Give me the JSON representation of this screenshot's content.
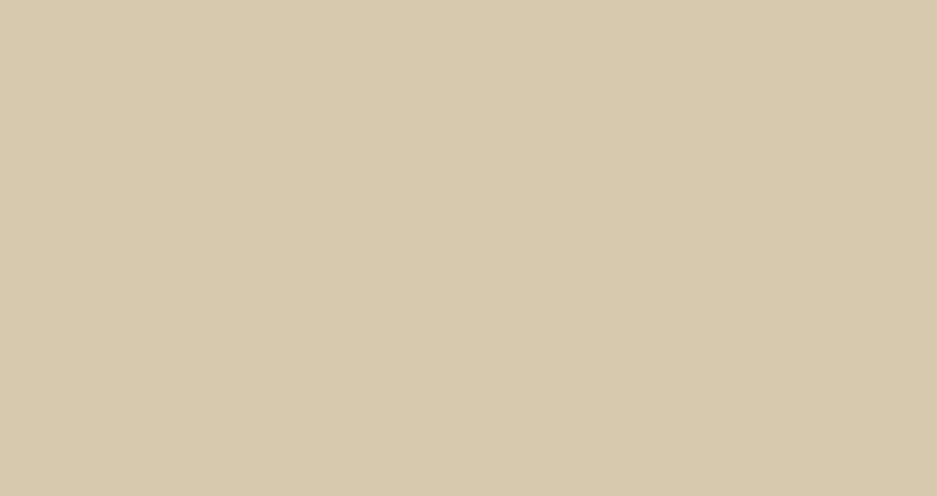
{
  "scene": {
    "type": "aerial-architectural-rendering",
    "description": "Bird's-eye architectural rendering of a large exhibition and trade-market campus: rows of steel blue-grey vaulted exhibition halls with white curved skylights, a diagonal spine of curved white-ribbed pod buildings with pale yellow-green oval roofs, two striped elliptical glass towers and a stacked white lattice tower, a central white lattice canopy over a road crossing, a wide tree-lined boulevard on the west, dense forest to the north-west, apartment blocks among trees on the east and south, a dark canal along the south-east edge with a road bridge, truck yards, parking rows and palm-lined internal streets, all washed by warm hazy sunlight from the upper left.",
    "setting": "daytime, warm sun flare from upper-left corner",
    "inventory": {
      "large_exhibition_halls": 11,
      "market_canopy_strips": 9,
      "organic_pod_buildings": 11,
      "striped_elliptical_towers": 2,
      "lattice_tower_tiers": 4,
      "central_lattice_canopy": 1,
      "pedestrian_bridges": 2,
      "sports_field": 1,
      "apartment_blocks": "~30",
      "truck_rows": 4,
      "canal": 1,
      "boulevard_lanes": "~8 with planted medians"
    }
  },
  "palette": {
    "paveLight": "#ecdfc5",
    "pave": "#d6c9ad",
    "paveDark": "#b3a588",
    "forestBase": "#5a6b41",
    "forestDark": "#475634",
    "forestMid": "#66784a",
    "forestLight": "#7e8e58",
    "forestSun": "#a6a56c",
    "forestGold": "#c6b886",
    "sageGround": "#8d9771",
    "sageTree": "#75835b",
    "sageTreeLight": "#8f9b74",
    "sageTreeDark": "#5f6e49",
    "darkGround": "#323d2a",
    "darkTree": "#2b3723",
    "darkTree2": "#3d4b30",
    "asphalt": "#8f8c84",
    "asphaltLight": "#a09d94",
    "laneYellow": "#d6c253",
    "laneWhite": "#ebebe4",
    "median": "#67764b",
    "curb": "#c0b89f",
    "hallRoofLight": "#bac7d9",
    "hallRoofMid": "#8ca1bb",
    "hallRoofDark": "#7289a6",
    "stripRoof": "#a9b6c8",
    "hallFacade": "#3d4e63",
    "hallTrim": "#dde3ea",
    "mullion": "#8ea0b6",
    "skylight": "#f8fafc",
    "canalDeep": "#203b4d",
    "canalStreak": "#4b6d82",
    "canalEdge": "#16293a",
    "blockTop": "#b8b4a2",
    "blockSide": "#8f8c79",
    "blockEnd": "#dcd9cc",
    "blockDarkTop": "#757764",
    "blockDarkSide": "#55574a",
    "blockGreyTop": "#a5a293",
    "blockGreySide": "#7f7c6d",
    "podBody": "#f4f1e4",
    "podRoof": "#e9e9ac",
    "podRim": "#fbf8ee",
    "podShade": "#d9d4c0",
    "cream": "#efe9d6",
    "greenRoof": "#9db26a",
    "lawn": "#dce4a8",
    "storefront": "#b97e37",
    "umbrellaRed": "#cf3528",
    "bandLight": "#f5f7f6",
    "bandBlue": "#8fb7cd",
    "towerTop": "#e2ecee",
    "towerTopLine": "#c3d2d6",
    "diagrid": "#c9cabd",
    "bridgeYellow": "#e5b93c",
    "truckWhite": "#f0f0ea",
    "truckRed": "#b5372a",
    "carDark": "#343a40",
    "carWhite": "#eeeee8",
    "carGrey": "#9aa1a8",
    "carRed": "#87302a",
    "carBlue": "#4a5a74",
    "sunCore": "#ffffff",
    "sunWarm": "#fff0d2"
  }
}
